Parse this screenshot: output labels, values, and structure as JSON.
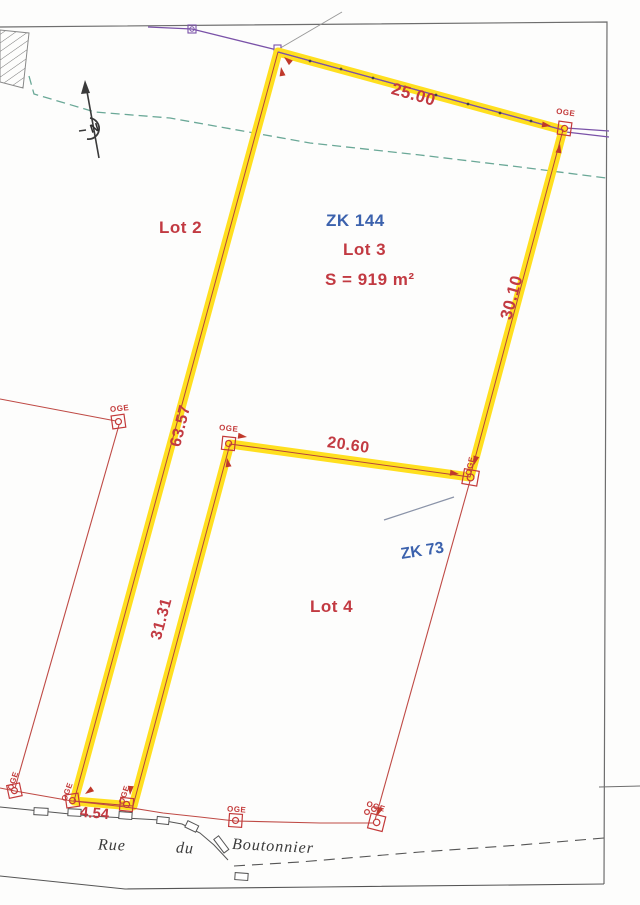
{
  "plan": {
    "north_label": "N",
    "parcel": {
      "cadastral_ref": "ZK 144",
      "lot_label": "Lot 3",
      "area_label": "S = 919 m²"
    },
    "adjacent_lots": {
      "lot2_label": "Lot 2",
      "lot4_label": "Lot 4"
    },
    "old_parcel_ref": "ZK 73",
    "dimensions": {
      "top_m": "25.00",
      "right_m": "30.10",
      "inner_m": "20.60",
      "left_m": "63.57",
      "strip_m": "31.31",
      "street_m": "4.54"
    },
    "street_name": {
      "w1": "Rue",
      "w2": "du",
      "w3": "Boutonnier"
    },
    "marker_type_label": "OGE",
    "colors": {
      "highlight_yellow": "#ffdf1f",
      "survey_red": "#c23a42",
      "reference_blue": "#3c62ad",
      "utility_purple": "#7a52a8",
      "vegetation_green": "#6aa897"
    }
  }
}
